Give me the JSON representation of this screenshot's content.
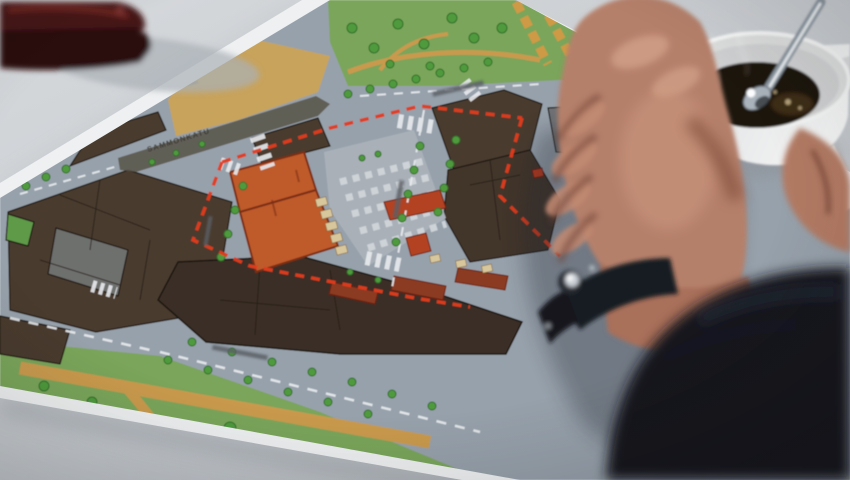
{
  "scene": {
    "caption": "Photograph: a hand rests on a printed urban development plan lying on a light table, beside a cup of black coffee with a spoon; a dark red case sits top-left; red dashed lines on the map outline a development area around an orange highlighted building."
  },
  "map_text": {
    "street_label": "SAMMONKATU"
  },
  "colors": {
    "paper_white": "#eef0f1",
    "table_gray": "#cdd1d5",
    "street_gray": "#97a1ab",
    "market_gray": "#a9b0b8",
    "park_green": "#7aa55a",
    "tree_green": "#4f9a3e",
    "ground_tan": "#c8a35b",
    "path_tan": "#c99a4e",
    "allotment_orange": "#cf9a44",
    "building_brown": "#4a3b2f",
    "building_dark": "#3a2f26",
    "building_gray": "#6e7174",
    "highlight_orange": "#bf5a2c",
    "stall_beige": "#d8c79c",
    "boundary_red": "#e23b1e",
    "marking_white": "#e8ebee",
    "skin": "#b5806b",
    "skin_shadow": "#7c4a3a",
    "sleeve_dark": "#14161e",
    "watch_silver": "#c9cfd6",
    "cup_white": "#e9eaeb",
    "coffee_brown": "#1a1208",
    "case_maroon": "#451318"
  }
}
